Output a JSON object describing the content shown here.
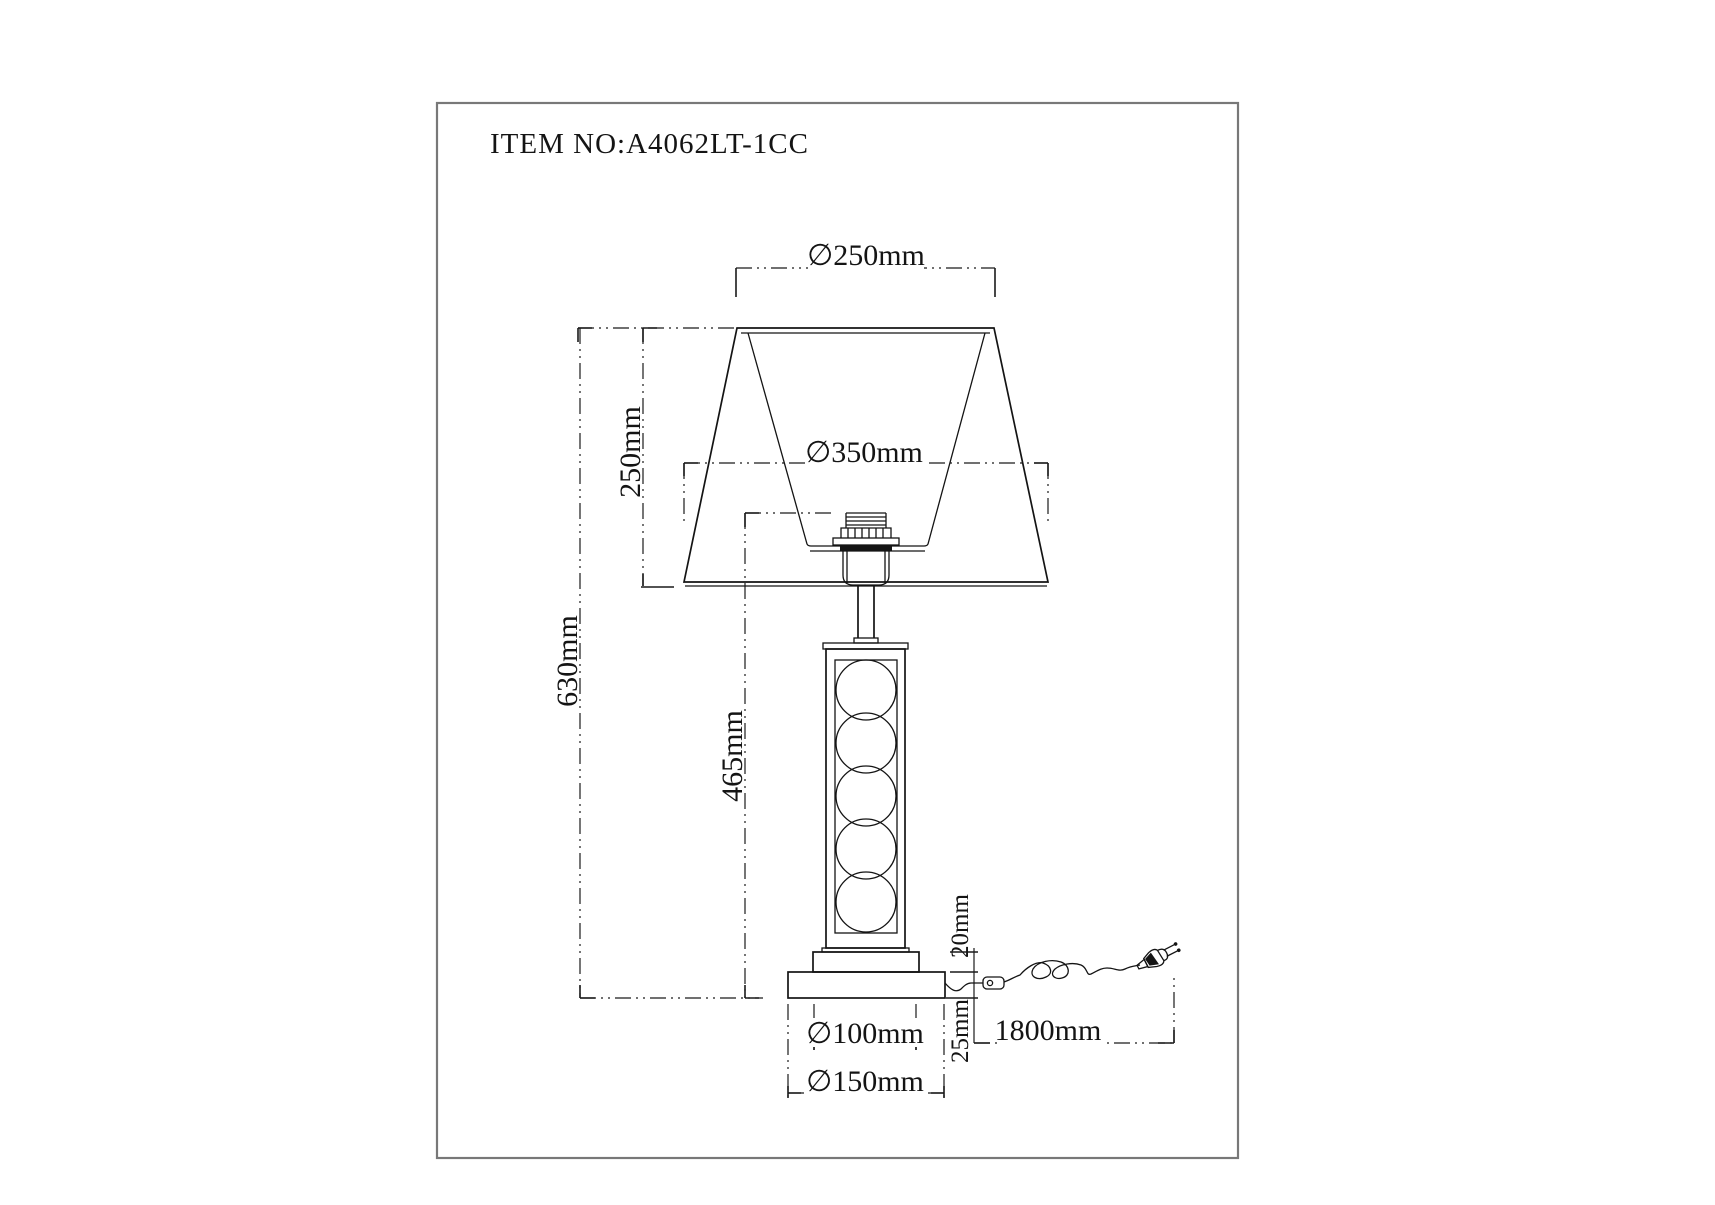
{
  "title": "ITEM NO:A4062LT-1CC",
  "dimensions": {
    "shade_top_diameter": "∅250mm",
    "shade_bottom_diameter": "∅350mm",
    "shade_height": "250mm",
    "total_height": "630mm",
    "body_height": "465mm",
    "step_height": "20mm",
    "base_height": "25mm",
    "step_diameter": "∅100mm",
    "base_diameter": "∅150mm",
    "cord_length": "1800mm"
  },
  "colors": {
    "background": "#ffffff",
    "line": "#141414",
    "dimension": "#1a1a1a",
    "frame": "#787878"
  }
}
